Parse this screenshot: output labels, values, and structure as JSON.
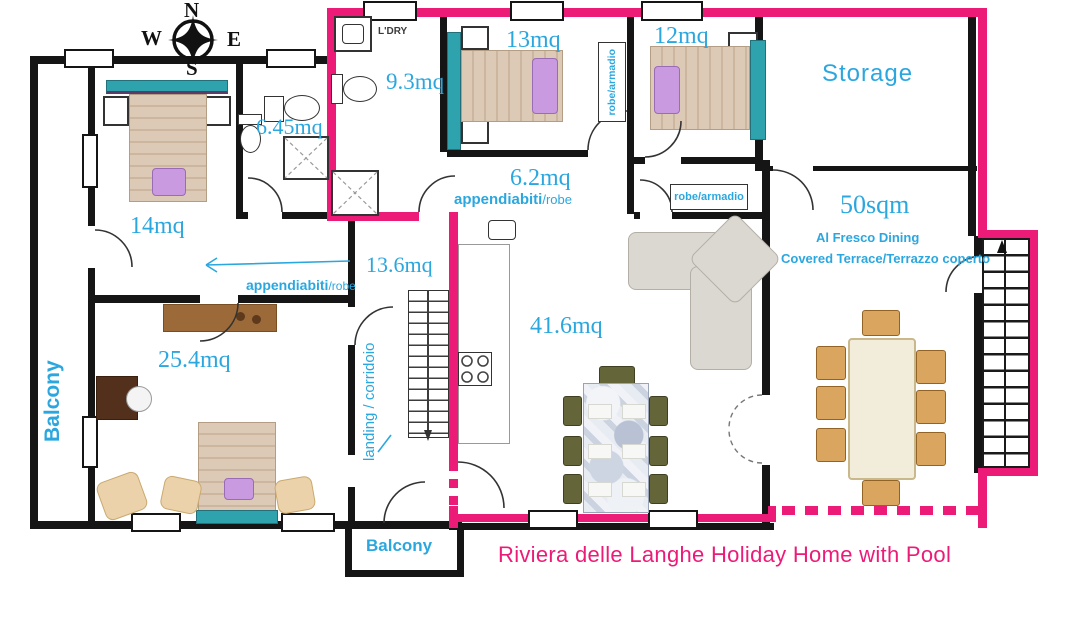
{
  "title": "Riviera delle Langhe Holiday Home with Pool",
  "colors": {
    "pink": "#EC1B77",
    "cyan": "#2BA7DF"
  },
  "compass": {
    "n": "N",
    "w": "W",
    "e": "E",
    "s": "S"
  },
  "rooms": {
    "bed14": "14mq",
    "bath645": "6.45mq",
    "bath93": "9.3mq",
    "bed13": "13mq",
    "bed12": "12mq",
    "storage": "Storage",
    "hall62": "6.2mq",
    "landing136": "13.6mq",
    "suite254": "25.4mq",
    "living416": "41.6mq",
    "terrace_size": "50sqm",
    "terrace_line1": "Al Fresco Dining",
    "terrace_line2": "Covered Terrace/Terrazzo coperto"
  },
  "features": {
    "laundry": "L'DRY",
    "robe_top": "robe/armadio",
    "robe_mid": "robe/armadio",
    "appendiabiti_hall": "appendiabiti",
    "appendiabiti_hall_suffix": "/robe",
    "appendiabiti_suite": "appendiabiti",
    "appendiabiti_suite_suffix": "/robe",
    "landing_corridor": "landing / corridoio",
    "balcony_left": "Balcony",
    "balcony_bottom": "Balcony"
  }
}
